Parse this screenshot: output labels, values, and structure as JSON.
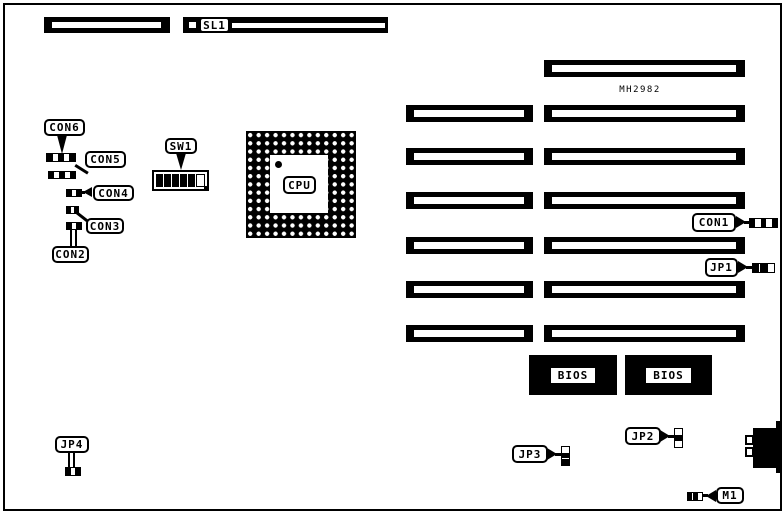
{
  "labels": {
    "sl1": "SL1",
    "con6": "CON6",
    "con5": "CON5",
    "con4": "CON4",
    "con3": "CON3",
    "con2": "CON2",
    "con1": "CON1",
    "sw1": "SW1",
    "cpu": "CPU",
    "chip": "MH2982",
    "bios_left": "BIOS",
    "bios_right": "BIOS",
    "jp1": "JP1",
    "jp2": "JP2",
    "jp3": "JP3",
    "jp4": "JP4",
    "m1": "M1"
  },
  "colors": {
    "ink": "#000000",
    "paper": "#ffffff"
  }
}
